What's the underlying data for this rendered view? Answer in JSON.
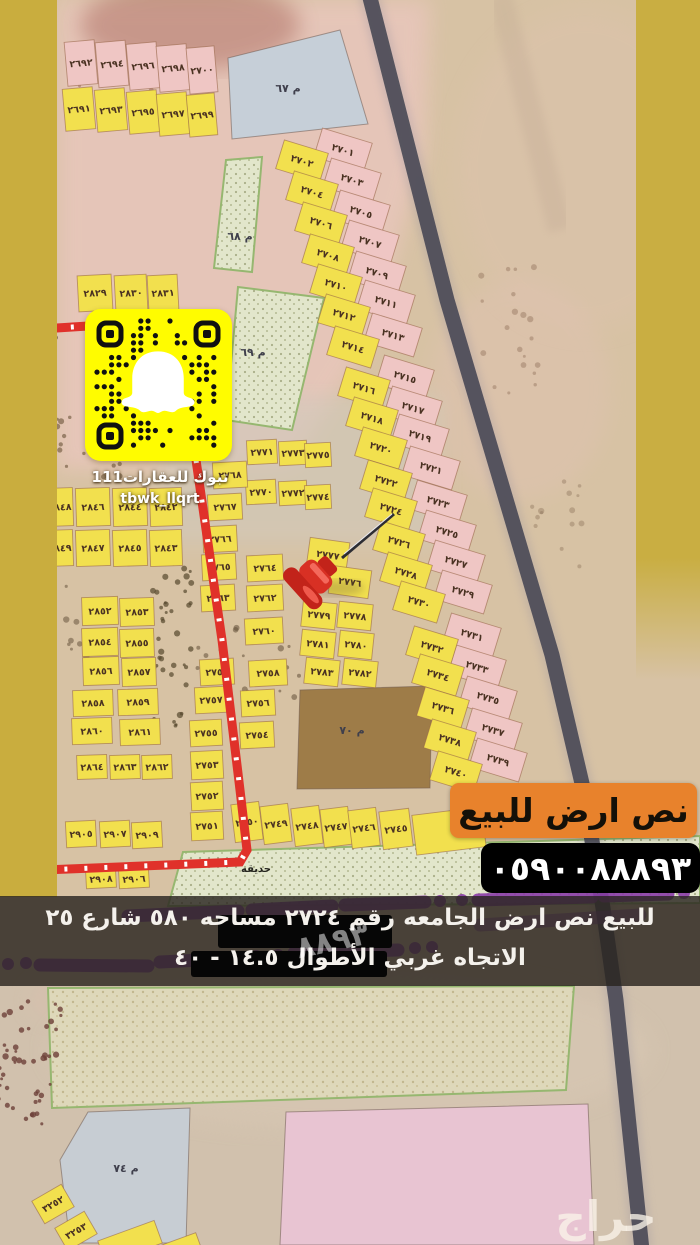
{
  "qr": {
    "platform": "snapchat-code",
    "caption1": "تبوك للعقارات111",
    "caption2": "tbwk_llqrt"
  },
  "banners": {
    "sale": "نص ارض للبيع",
    "phone": "٠٥٩٠٠٨٨٨٩٣",
    "desc_line1": "للبيع نص ارض الجامعه رقم ٢٧٢٤ مساحه ٥٨٠ شارع ٢٥",
    "desc_line2": "الاتجاه غربي الأطوال ١٤.٥ - ٤٠",
    "ghost_digits": "٨٨٩٣"
  },
  "watermark": "حراج",
  "map": {
    "park_label": "حديقه",
    "palette": {
      "y": "#f2e04e",
      "p": "#efc6c4",
      "blue": "#c6cfd8",
      "bluegray": "#c7cdd3",
      "brown": "#9e7c48",
      "pink2": "#e8c4d2",
      "green": "#e2e6cb",
      "sand": "#ded8ba",
      "strip": "#c9ad3e",
      "highway": "#4f4e5a",
      "route": "#e0312a",
      "orange": "#e8822c",
      "snap": "#fffc00",
      "purple": "#8a3da8"
    },
    "areas": [
      {
        "name": "block-67",
        "label": "م ٦٧",
        "points": "228,58 340,30 368,124 232,139",
        "fill": "blue",
        "lx": 288,
        "ly": 92
      },
      {
        "name": "strip-68",
        "label": "م ٦٨",
        "points": "226,160 262,157 252,272 214,268",
        "fill": "green",
        "lx": 240,
        "ly": 240
      },
      {
        "name": "strip-69",
        "label": "م ٦٩",
        "points": "238,287 324,298 292,430 226,420",
        "fill": "green",
        "lx": 253,
        "ly": 356
      },
      {
        "name": "block-70",
        "label": "م ٧٠",
        "points": "300,690 432,686 430,788 297,789",
        "fill": "brown",
        "lx": 352,
        "ly": 734
      },
      {
        "name": "park-band",
        "label": "",
        "points": "183,852 700,836 700,903 168,906",
        "fill": "green",
        "lx": 0,
        "ly": 0
      },
      {
        "name": "sand-parcel",
        "label": "",
        "points": "48,988 574,986 566,1090 52,1108",
        "fill": "sand",
        "lx": 0,
        "ly": 0
      },
      {
        "name": "block-74",
        "label": "م ٧٤",
        "points": "88,1112 190,1108 186,1243 70,1243 60,1160",
        "fill": "bluegray",
        "lx": 126,
        "ly": 1172
      },
      {
        "name": "pink-parcel",
        "label": "",
        "points": "286,1112 588,1104 594,1245 280,1245",
        "fill": "pink2",
        "lx": 0,
        "ly": 0
      }
    ],
    "parcels": [
      [
        "٢٦٩٢",
        81,
        63,
        30,
        44,
        -5,
        "p"
      ],
      [
        "٢٦٩٤",
        112,
        64,
        30,
        45,
        -5,
        "p"
      ],
      [
        "٢٦٩٦",
        143,
        66,
        30,
        46,
        -5,
        "p"
      ],
      [
        "٢٦٩٨",
        173,
        68,
        30,
        46,
        -5,
        "p"
      ],
      [
        "٢٧٠٠",
        202,
        70,
        28,
        46,
        -5,
        "p"
      ],
      [
        "٢٦٩١",
        79,
        109,
        30,
        42,
        -5,
        "y"
      ],
      [
        "٢٦٩٣",
        111,
        110,
        30,
        42,
        -5,
        "y"
      ],
      [
        "٢٦٩٥",
        143,
        112,
        30,
        42,
        -5,
        "y"
      ],
      [
        "٢٦٩٧",
        173,
        114,
        30,
        42,
        -5,
        "y"
      ],
      [
        "٢٦٩٩",
        202,
        115,
        28,
        42,
        -5,
        "y"
      ],
      [
        "٢٨٢٩",
        95,
        293,
        34,
        36,
        -3,
        "y"
      ],
      [
        "٢٨٣٠",
        131,
        293,
        32,
        36,
        -3,
        "y"
      ],
      [
        "٢٨٣١",
        163,
        293,
        30,
        36,
        -3,
        "y"
      ],
      [
        "٢٧٠١",
        343,
        150,
        52,
        30,
        17,
        "p"
      ],
      [
        "٢٧٠٣",
        352,
        180,
        52,
        30,
        17,
        "p"
      ],
      [
        "٢٧٠٥",
        361,
        212,
        52,
        30,
        17,
        "p"
      ],
      [
        "٢٧٠٧",
        370,
        242,
        52,
        30,
        17,
        "p"
      ],
      [
        "٢٧٠٩",
        377,
        273,
        52,
        30,
        17,
        "p"
      ],
      [
        "٢٧١١",
        386,
        302,
        52,
        30,
        17,
        "p"
      ],
      [
        "٢٧١٣",
        393,
        335,
        52,
        30,
        17,
        "p"
      ],
      [
        "٢٧١٥",
        405,
        377,
        52,
        30,
        17,
        "p"
      ],
      [
        "٢٧١٧",
        413,
        408,
        52,
        30,
        17,
        "p"
      ],
      [
        "٢٧١٩",
        420,
        436,
        52,
        30,
        17,
        "p"
      ],
      [
        "٢٧٢١",
        431,
        468,
        52,
        30,
        17,
        "p"
      ],
      [
        "٢٧٢٣",
        438,
        502,
        52,
        30,
        17,
        "p"
      ],
      [
        "٢٧٢٥",
        447,
        532,
        52,
        30,
        17,
        "p"
      ],
      [
        "٢٧٢٧",
        456,
        562,
        52,
        30,
        17,
        "p"
      ],
      [
        "٢٧٢٩",
        463,
        592,
        52,
        30,
        17,
        "p"
      ],
      [
        "٢٧٣١",
        472,
        635,
        52,
        30,
        17,
        "p"
      ],
      [
        "٢٧٣٣",
        477,
        667,
        52,
        30,
        17,
        "p"
      ],
      [
        "٢٧٣٥",
        488,
        698,
        52,
        30,
        17,
        "p"
      ],
      [
        "٢٧٣٧",
        493,
        730,
        52,
        30,
        17,
        "p"
      ],
      [
        "٢٧٣٩",
        498,
        760,
        52,
        30,
        17,
        "p"
      ],
      [
        "٢٧٠٢",
        302,
        161,
        46,
        30,
        17,
        "y"
      ],
      [
        "٢٧٠٤",
        312,
        192,
        46,
        30,
        17,
        "y"
      ],
      [
        "٢٧٠٦",
        321,
        223,
        46,
        30,
        17,
        "y"
      ],
      [
        "٢٧٠٨",
        328,
        255,
        46,
        30,
        17,
        "y"
      ],
      [
        "٢٧١٠",
        336,
        285,
        46,
        30,
        17,
        "y"
      ],
      [
        "٢٧١٢",
        344,
        315,
        46,
        30,
        17,
        "y"
      ],
      [
        "٢٧١٤",
        353,
        347,
        46,
        30,
        17,
        "y"
      ],
      [
        "٢٧١٦",
        364,
        388,
        46,
        30,
        17,
        "y"
      ],
      [
        "٢٧١٨",
        372,
        418,
        46,
        30,
        17,
        "y"
      ],
      [
        "٢٧٢٠",
        381,
        448,
        46,
        30,
        17,
        "y"
      ],
      [
        "٢٧٢٢",
        386,
        481,
        46,
        30,
        17,
        "y"
      ],
      [
        "٢٧٢٤",
        391,
        509,
        46,
        30,
        17,
        "y"
      ],
      [
        "٢٧٢٦",
        399,
        542,
        46,
        30,
        17,
        "y"
      ],
      [
        "٢٧٢٨",
        406,
        573,
        46,
        30,
        17,
        "y"
      ],
      [
        "٢٧٣٠",
        419,
        602,
        46,
        30,
        17,
        "y"
      ],
      [
        "٢٧٣٢",
        432,
        647,
        46,
        30,
        17,
        "y"
      ],
      [
        "٢٧٣٤",
        438,
        675,
        46,
        30,
        17,
        "y"
      ],
      [
        "٢٧٣٦",
        443,
        708,
        46,
        30,
        17,
        "y"
      ],
      [
        "٢٧٣٨",
        450,
        740,
        46,
        30,
        17,
        "y"
      ],
      [
        "٢٧٤٠",
        456,
        772,
        46,
        30,
        17,
        "y"
      ],
      [
        "٢٨٤٨",
        60,
        507,
        26,
        38,
        -2,
        "y"
      ],
      [
        "٢٨٤٦",
        93,
        507,
        34,
        38,
        -2,
        "y"
      ],
      [
        "٢٨٤٤",
        130,
        507,
        34,
        38,
        -2,
        "y"
      ],
      [
        "٢٨٤٢",
        166,
        507,
        32,
        38,
        -2,
        "y"
      ],
      [
        "٢٨٤٩",
        60,
        548,
        26,
        36,
        -2,
        "y"
      ],
      [
        "٢٨٤٧",
        93,
        548,
        34,
        36,
        -2,
        "y"
      ],
      [
        "٢٨٤٥",
        130,
        548,
        34,
        36,
        -2,
        "y"
      ],
      [
        "٢٨٤٣",
        166,
        548,
        32,
        36,
        -2,
        "y"
      ],
      [
        "٢٨٥٢",
        100,
        611,
        36,
        28,
        -2,
        "y"
      ],
      [
        "٢٨٥٣",
        137,
        612,
        34,
        28,
        -2,
        "y"
      ],
      [
        "٢٨٥٤",
        100,
        642,
        36,
        28,
        -2,
        "y"
      ],
      [
        "٢٨٥٥",
        137,
        643,
        34,
        28,
        -2,
        "y"
      ],
      [
        "٢٨٥٦",
        101,
        671,
        36,
        28,
        -2,
        "y"
      ],
      [
        "٢٨٥٧",
        139,
        672,
        34,
        28,
        -2,
        "y"
      ],
      [
        "٢٨٥٨",
        93,
        703,
        40,
        26,
        -2,
        "y"
      ],
      [
        "٢٨٥٩",
        138,
        702,
        40,
        26,
        -2,
        "y"
      ],
      [
        "٢٨٦٠",
        92,
        731,
        40,
        26,
        -2,
        "y"
      ],
      [
        "٢٨٦١",
        140,
        732,
        40,
        26,
        -2,
        "y"
      ],
      [
        "٢٨٦٤",
        92,
        767,
        30,
        24,
        -2,
        "y"
      ],
      [
        "٢٨٦٣",
        125,
        767,
        30,
        24,
        -2,
        "y"
      ],
      [
        "٢٨٦٢",
        157,
        767,
        30,
        24,
        -2,
        "y"
      ],
      [
        "٢٩٠٥",
        81,
        834,
        30,
        26,
        -3,
        "y"
      ],
      [
        "٢٩٠٧",
        115,
        834,
        30,
        26,
        -3,
        "y"
      ],
      [
        "٢٩٠٩",
        147,
        835,
        30,
        26,
        -3,
        "y"
      ],
      [
        "٢٩٠٨",
        101,
        879,
        30,
        18,
        -3,
        "y"
      ],
      [
        "٢٩٠٦",
        134,
        879,
        30,
        18,
        -3,
        "y"
      ],
      [
        "٢٧٧١",
        262,
        452,
        30,
        24,
        -3,
        "y"
      ],
      [
        "٢٧٧٣",
        293,
        453,
        28,
        24,
        -3,
        "y"
      ],
      [
        "٢٧٧٥",
        318,
        455,
        26,
        24,
        -3,
        "y"
      ],
      [
        "٢٧٧٠",
        261,
        492,
        30,
        24,
        -3,
        "y"
      ],
      [
        "٢٧٧٢",
        293,
        493,
        28,
        24,
        -3,
        "y"
      ],
      [
        "٢٧٧٤",
        318,
        497,
        26,
        24,
        -3,
        "y"
      ],
      [
        "٢٧٦٨",
        230,
        475,
        34,
        26,
        -3,
        "y"
      ],
      [
        "٢٧٦٧",
        225,
        507,
        34,
        26,
        -3,
        "y"
      ],
      [
        "٢٧٦٦",
        220,
        539,
        34,
        26,
        -3,
        "y"
      ],
      [
        "٢٧٦٥",
        219,
        567,
        34,
        26,
        -3,
        "y"
      ],
      [
        "٢٧٦٤",
        265,
        568,
        36,
        26,
        -3,
        "y"
      ],
      [
        "٢٧٦٣",
        218,
        598,
        34,
        26,
        -3,
        "y"
      ],
      [
        "٢٧٦٢",
        265,
        598,
        36,
        26,
        -3,
        "y"
      ],
      [
        "٢٧٦٠",
        264,
        631,
        38,
        26,
        -3,
        "y"
      ],
      [
        "٢٧٥٩",
        217,
        672,
        34,
        26,
        -3,
        "y"
      ],
      [
        "٢٧٥٨",
        268,
        673,
        38,
        26,
        -3,
        "y"
      ],
      [
        "٢٧٥٧",
        211,
        700,
        32,
        26,
        -3,
        "y"
      ],
      [
        "٢٧٥٦",
        258,
        703,
        34,
        26,
        -3,
        "y"
      ],
      [
        "٢٧٥٥",
        206,
        733,
        32,
        26,
        -3,
        "y"
      ],
      [
        "٢٧٥٤",
        257,
        735,
        34,
        26,
        -3,
        "y"
      ],
      [
        "٢٧٥٣",
        207,
        765,
        32,
        28,
        -3,
        "y"
      ],
      [
        "٢٧٥٢",
        207,
        796,
        32,
        28,
        -3,
        "y"
      ],
      [
        "٢٧٥١",
        207,
        826,
        32,
        28,
        -3,
        "y"
      ],
      [
        "٢٧٥٠",
        247,
        822,
        28,
        38,
        -7,
        "y"
      ],
      [
        "٢٧٤٩",
        276,
        824,
        28,
        38,
        -7,
        "y"
      ],
      [
        "٢٧٤٨",
        307,
        826,
        28,
        38,
        -7,
        "y"
      ],
      [
        "٢٧٤٧",
        336,
        827,
        28,
        38,
        -7,
        "y"
      ],
      [
        "٢٧٤٦",
        364,
        828,
        28,
        38,
        -7,
        "y"
      ],
      [
        "٢٧٤٥",
        396,
        829,
        30,
        38,
        -7,
        "y"
      ],
      [
        "",
        449,
        831,
        70,
        40,
        -7,
        "y"
      ],
      [
        "٢٧٧٧",
        328,
        555,
        40,
        30,
        8,
        "y"
      ],
      [
        "٢٧٧٦",
        350,
        582,
        40,
        28,
        8,
        "y"
      ],
      [
        "٢٧٧٩",
        319,
        615,
        34,
        26,
        6,
        "y"
      ],
      [
        "٢٧٧٨",
        355,
        616,
        34,
        26,
        6,
        "y"
      ],
      [
        "٢٧٨١",
        318,
        644,
        34,
        26,
        6,
        "y"
      ],
      [
        "٢٧٨٠",
        356,
        645,
        34,
        26,
        6,
        "y"
      ],
      [
        "٢٧٨٣",
        322,
        672,
        34,
        26,
        6,
        "y"
      ],
      [
        "٢٧٨٢",
        360,
        673,
        34,
        26,
        6,
        "y"
      ],
      [
        "٣٢٥٢",
        53,
        1204,
        34,
        26,
        -30,
        "y"
      ],
      [
        "٣٢٥٣",
        76,
        1231,
        34,
        26,
        -30,
        "y"
      ],
      [
        "",
        130,
        1242,
        60,
        24,
        -20,
        "y"
      ],
      [
        "",
        180,
        1248,
        40,
        18,
        -20,
        "y"
      ]
    ]
  }
}
